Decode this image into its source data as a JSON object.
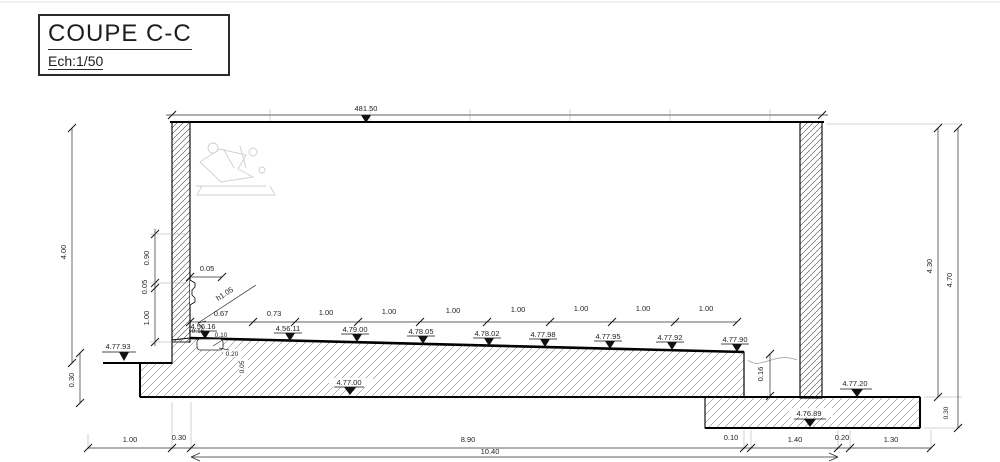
{
  "title_block": {
    "title": "COUPE C-C",
    "scale_label": "Ech:1/50"
  },
  "elevations": {
    "top": "481.50",
    "left_ground": "4.77.93",
    "floor": [
      "4.56.16",
      "4.56.11",
      "4.79.00",
      "4.78.05",
      "4.78.02",
      "4.77.98",
      "4.77.95",
      "4.77.92",
      "4.77.90"
    ],
    "slab_center": "4.77.00",
    "lower_slab_top": "4.77.20",
    "lower_slab_bottom": "4.76.89"
  },
  "dims": {
    "left_total": "4.00",
    "left_footing": "0.30",
    "wall_chain": [
      "0.90",
      "0.05",
      "1.00"
    ],
    "ledge": "0.05",
    "leader_note": "h1.05",
    "floor_chain": [
      "0.67",
      "0.73",
      "1.00",
      "1.00",
      "1.00",
      "1.00",
      "1.00",
      "1.00",
      "1.00"
    ],
    "channel": [
      "0.16",
      "0.10",
      "0.20",
      "0.05"
    ],
    "step_height": "0.16",
    "right_inner": "4.30",
    "right_outer": "4.70",
    "slab_thickness": "0.30",
    "bottom_chain": [
      "1.00",
      "0.30",
      "8.90",
      "0.10",
      "1.40",
      "0.20",
      "1.30"
    ],
    "bottom_total": "10.40"
  }
}
